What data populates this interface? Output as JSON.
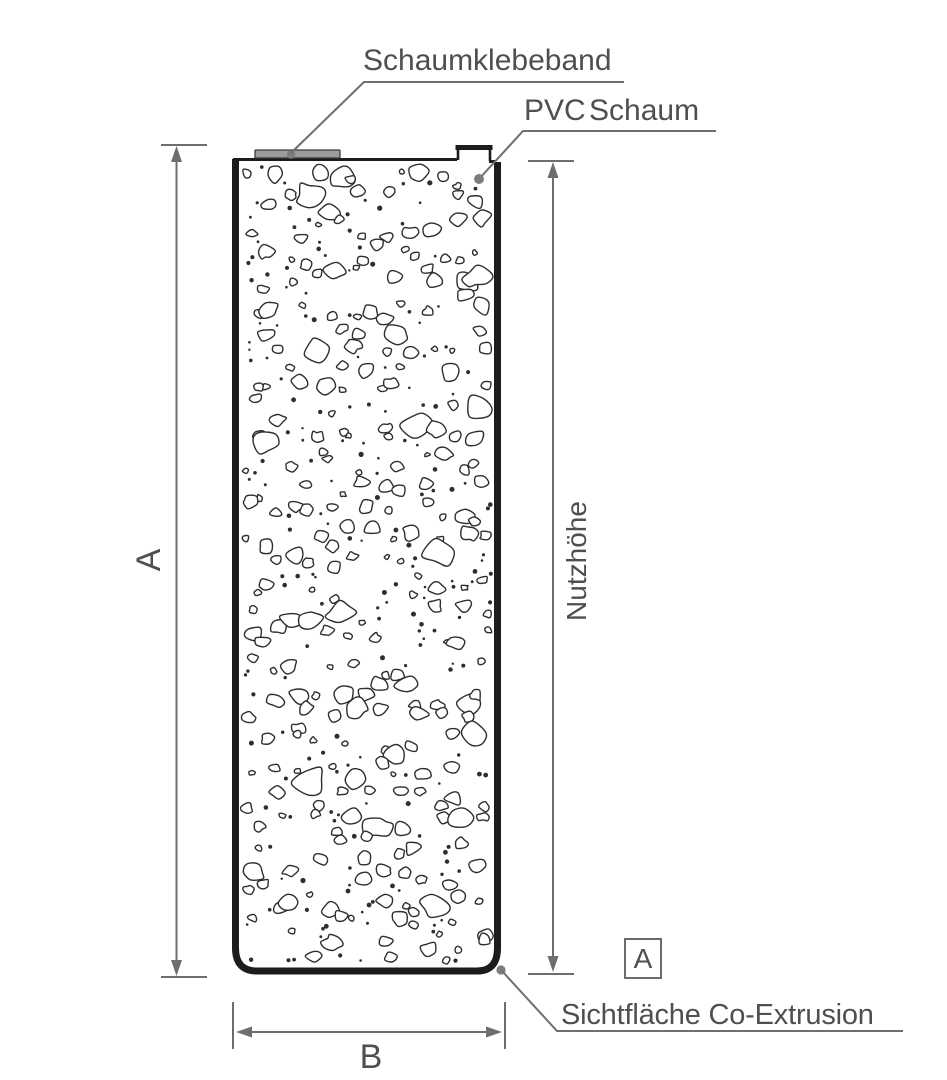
{
  "labels": {
    "schaumklebeband": "Schaumklebeband",
    "pvc_schaum": "PVC Schaum",
    "nutzhoehe": "Nutzhöhe",
    "overall_height": "A",
    "width": "B",
    "section_marker": "A",
    "sichtflaeche": "Sichtfläche Co-Extrusion"
  },
  "colors": {
    "dimension_line": "#6e6e6e",
    "label_text": "#4f4f4f",
    "panel_edge": "#1c1c1c",
    "texture_stroke": "#2e2e2e",
    "tape_fill": "#9c9c9c",
    "leader_dot": "#7d7d7d",
    "background": "#ffffff"
  }
}
